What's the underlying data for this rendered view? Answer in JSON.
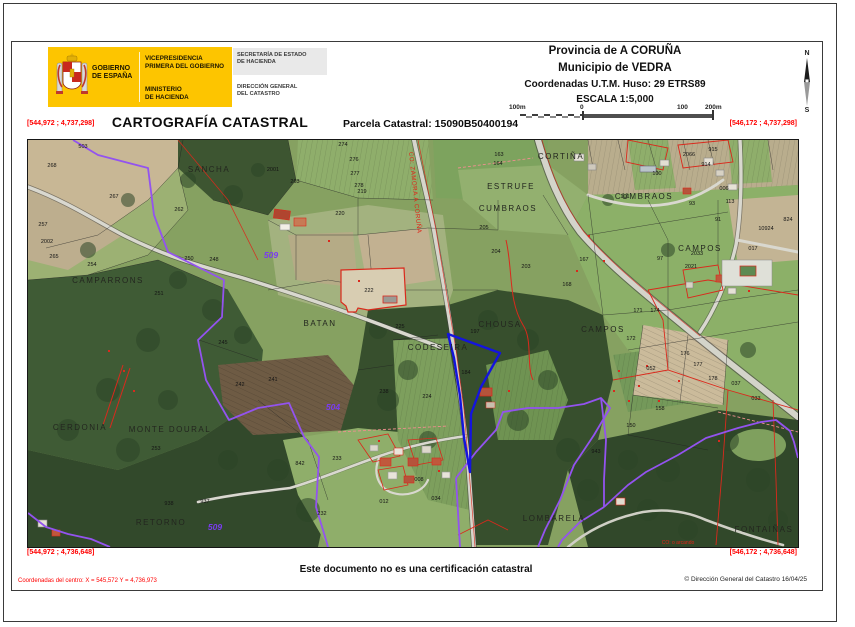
{
  "header": {
    "logo": {
      "gobierno_line1": "GOBIERNO",
      "gobierno_line2": "DE ESPAÑA",
      "vice_line1": "VICEPRESIDENCIA",
      "vice_line2": "PRIMERA DEL GOBIERNO",
      "min_line1": "MINISTERIO",
      "min_line2": "DE HACIENDA",
      "sec_line1": "SECRETARÍA DE ESTADO",
      "sec_line2": "DE HACIENDA",
      "dir_line1": "DIRECCIÓN GENERAL",
      "dir_line2": "DEL CATASTRO"
    },
    "provincia": "Provincia de A CORUÑA",
    "municipio": "Municipio de VEDRA",
    "coordenadas": "Coordenadas U.T.M. Huso: 29 ETRS89",
    "escala": "ESCALA 1:5,000",
    "scalebar": {
      "l0": "100m",
      "l1": "0",
      "l2": "100",
      "l3": "200m"
    },
    "compass_n": "N",
    "compass_s": "S"
  },
  "title": "CARTOGRAFÍA CATASTRAL",
  "parcela": "Parcela Catastral: 15090B50400194",
  "corners": {
    "top_left": "[544,972 ; 4,737,298]",
    "top_right": "[546,172 ; 4,737,298]",
    "bottom_left": "[544,972 ; 4,736,648]",
    "bottom_right": "[546,172 ; 4,736,648]"
  },
  "footer": {
    "disclaimer": "Este documento no es una certificación catastral",
    "centro": "Coordenadas del centro: X = 545,572 Y = 4,736,973",
    "copyright": "© Dirección General del Catastro 16/04/25"
  },
  "map": {
    "colors": {
      "parcel_blue": "#1414dd",
      "boundary_purple": "#9353ef",
      "cadastral_red": "#da291c"
    },
    "labels": [
      {
        "t": "CORTIÑA",
        "x": 533,
        "y": 19,
        "s": 8,
        "ls": 1.5,
        "c": "#23261f"
      },
      {
        "t": "SANCHA",
        "x": 181,
        "y": 32,
        "s": 8,
        "ls": 1.5,
        "c": "#23261f"
      },
      {
        "t": "ESTRUFE",
        "x": 483,
        "y": 49,
        "s": 8,
        "ls": 1.5,
        "c": "#23261f"
      },
      {
        "t": "CUMBRAOS",
        "x": 480,
        "y": 71,
        "s": 8,
        "ls": 1.5,
        "c": "#23261f"
      },
      {
        "t": "CUMBRAOS",
        "x": 616,
        "y": 59,
        "s": 8,
        "ls": 1.5,
        "c": "#23261f"
      },
      {
        "t": "CAMPOS",
        "x": 672,
        "y": 111,
        "s": 8,
        "ls": 1.5,
        "c": "#23261f"
      },
      {
        "t": "CAMPOS",
        "x": 575,
        "y": 192,
        "s": 8,
        "ls": 1.5,
        "c": "#23261f"
      },
      {
        "t": "CHOUSA",
        "x": 472,
        "y": 187,
        "s": 8,
        "ls": 1.5,
        "c": "#23261f"
      },
      {
        "t": "CODESEIRA",
        "x": 410,
        "y": 210,
        "s": 8,
        "ls": 1.5,
        "c": "#23261f"
      },
      {
        "t": "BATAN",
        "x": 292,
        "y": 186,
        "s": 8,
        "ls": 1.5,
        "c": "#23261f"
      },
      {
        "t": "CAMPARRONS",
        "x": 80,
        "y": 143,
        "s": 8,
        "ls": 1.5,
        "c": "#23261f"
      },
      {
        "t": "CERDONIA",
        "x": 52,
        "y": 290,
        "s": 8,
        "ls": 1.5,
        "c": "#23261f"
      },
      {
        "t": "MONTE DOURAL",
        "x": 142,
        "y": 292,
        "s": 8,
        "ls": 1.5,
        "c": "#23261f"
      },
      {
        "t": "RETORNO",
        "x": 133,
        "y": 385,
        "s": 8,
        "ls": 1.5,
        "c": "#23261f"
      },
      {
        "t": "LOMBARELA",
        "x": 526,
        "y": 381,
        "s": 8,
        "ls": 1.5,
        "c": "#23261f"
      },
      {
        "t": "FONTAIÑAS",
        "x": 736,
        "y": 392,
        "s": 8,
        "ls": 1.5,
        "c": "#23261f"
      },
      {
        "t": "509",
        "x": 243,
        "y": 118,
        "s": 8.5,
        "c": "#7a3bf0",
        "b": 1,
        "i": 1
      },
      {
        "t": "509",
        "x": 187,
        "y": 390,
        "s": 8.5,
        "c": "#7a3bf0",
        "b": 1,
        "i": 1
      },
      {
        "t": "504",
        "x": 305,
        "y": 270,
        "s": 8.5,
        "c": "#7a3bf0",
        "b": 1,
        "i": 1
      },
      {
        "t": "CO: ZAMORA A CORUÑA",
        "x": 381,
        "y": 12,
        "s": 6.2,
        "c": "#e02418",
        "r": 84,
        "a": "start",
        "ls": 0.5
      },
      {
        "t": "CO: o arcando",
        "x": 650,
        "y": 404,
        "s": 5,
        "c": "#e02418"
      },
      {
        "t": "503",
        "x": 55,
        "y": 8
      },
      {
        "t": "268",
        "x": 24,
        "y": 27
      },
      {
        "t": "267",
        "x": 86,
        "y": 58
      },
      {
        "t": "2001",
        "x": 245,
        "y": 31
      },
      {
        "t": "263",
        "x": 267,
        "y": 43
      },
      {
        "t": "262",
        "x": 151,
        "y": 71
      },
      {
        "t": "257",
        "x": 15,
        "y": 86
      },
      {
        "t": "2002",
        "x": 19,
        "y": 103
      },
      {
        "t": "265",
        "x": 26,
        "y": 118
      },
      {
        "t": "254",
        "x": 64,
        "y": 126
      },
      {
        "t": "250",
        "x": 161,
        "y": 120
      },
      {
        "t": "248",
        "x": 186,
        "y": 121
      },
      {
        "t": "251",
        "x": 131,
        "y": 155
      },
      {
        "t": "253",
        "x": 128,
        "y": 310
      },
      {
        "t": "245",
        "x": 195,
        "y": 204
      },
      {
        "t": "238",
        "x": 356,
        "y": 253
      },
      {
        "t": "224",
        "x": 399,
        "y": 258
      },
      {
        "t": "222",
        "x": 341,
        "y": 152
      },
      {
        "t": "225",
        "x": 372,
        "y": 188
      },
      {
        "t": "197",
        "x": 447,
        "y": 193
      },
      {
        "t": "184",
        "x": 438,
        "y": 234
      },
      {
        "t": "274",
        "x": 315,
        "y": 6
      },
      {
        "t": "276",
        "x": 326,
        "y": 21
      },
      {
        "t": "277",
        "x": 327,
        "y": 35
      },
      {
        "t": "278",
        "x": 331,
        "y": 47
      },
      {
        "t": "219",
        "x": 334,
        "y": 53
      },
      {
        "t": "220",
        "x": 312,
        "y": 75
      },
      {
        "t": "163",
        "x": 471,
        "y": 16
      },
      {
        "t": "164",
        "x": 470,
        "y": 25
      },
      {
        "t": "167",
        "x": 556,
        "y": 121
      },
      {
        "t": "168",
        "x": 539,
        "y": 146
      },
      {
        "t": "101",
        "x": 597,
        "y": 58
      },
      {
        "t": "100",
        "x": 629,
        "y": 35
      },
      {
        "t": "2066",
        "x": 661,
        "y": 16
      },
      {
        "t": "915",
        "x": 685,
        "y": 11
      },
      {
        "t": "914",
        "x": 678,
        "y": 26
      },
      {
        "t": "006",
        "x": 696,
        "y": 50
      },
      {
        "t": "113",
        "x": 702,
        "y": 63
      },
      {
        "t": "93",
        "x": 664,
        "y": 65
      },
      {
        "t": "91",
        "x": 690,
        "y": 81
      },
      {
        "t": "97",
        "x": 632,
        "y": 120
      },
      {
        "t": "824",
        "x": 760,
        "y": 81
      },
      {
        "t": "10924",
        "x": 738,
        "y": 90
      },
      {
        "t": "017",
        "x": 725,
        "y": 110
      },
      {
        "t": "2033",
        "x": 669,
        "y": 115
      },
      {
        "t": "2021",
        "x": 663,
        "y": 128
      },
      {
        "t": "171",
        "x": 610,
        "y": 172
      },
      {
        "t": "174",
        "x": 627,
        "y": 172
      },
      {
        "t": "172",
        "x": 603,
        "y": 200
      },
      {
        "t": "176",
        "x": 657,
        "y": 215
      },
      {
        "t": "177",
        "x": 670,
        "y": 226
      },
      {
        "t": "178",
        "x": 685,
        "y": 240
      },
      {
        "t": "052",
        "x": 623,
        "y": 230
      },
      {
        "t": "037",
        "x": 708,
        "y": 245
      },
      {
        "t": "033",
        "x": 728,
        "y": 260
      },
      {
        "t": "012",
        "x": 356,
        "y": 363
      },
      {
        "t": "034",
        "x": 408,
        "y": 360
      },
      {
        "t": "008",
        "x": 391,
        "y": 341
      },
      {
        "t": "241",
        "x": 245,
        "y": 241
      },
      {
        "t": "242",
        "x": 212,
        "y": 246
      },
      {
        "t": "938",
        "x": 141,
        "y": 365
      },
      {
        "t": "937",
        "x": 177,
        "y": 363
      },
      {
        "t": "842",
        "x": 272,
        "y": 325
      },
      {
        "t": "233",
        "x": 309,
        "y": 320
      },
      {
        "t": "232",
        "x": 294,
        "y": 375
      },
      {
        "t": "943",
        "x": 568,
        "y": 313
      },
      {
        "t": "158",
        "x": 632,
        "y": 270
      },
      {
        "t": "150",
        "x": 603,
        "y": 287
      },
      {
        "t": "203",
        "x": 498,
        "y": 128
      },
      {
        "t": "204",
        "x": 468,
        "y": 113
      },
      {
        "t": "205",
        "x": 456,
        "y": 89
      }
    ]
  }
}
